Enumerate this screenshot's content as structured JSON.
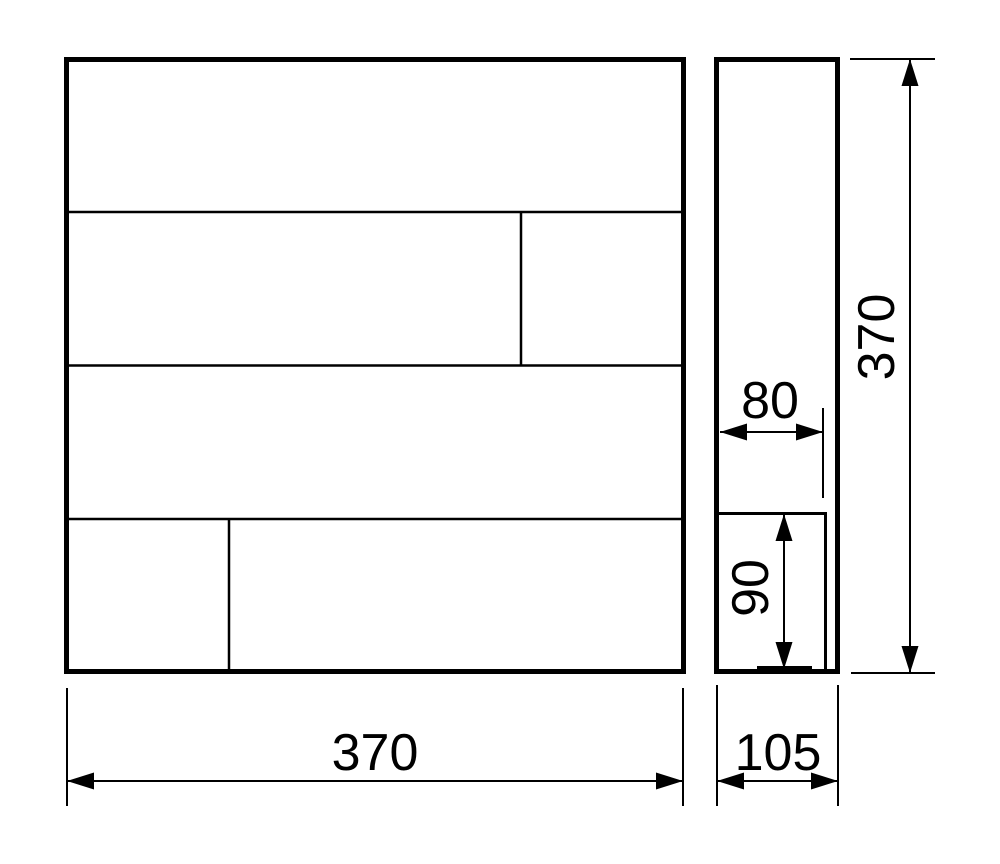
{
  "dimensions": {
    "front_width": {
      "value": "370"
    },
    "front_height": {
      "value": "370"
    },
    "side_depth": {
      "value": "105"
    },
    "slot_depth": {
      "value": "80"
    },
    "slot_height": {
      "value": "90"
    }
  },
  "colors": {
    "line": "#000000",
    "background": "#ffffff"
  }
}
